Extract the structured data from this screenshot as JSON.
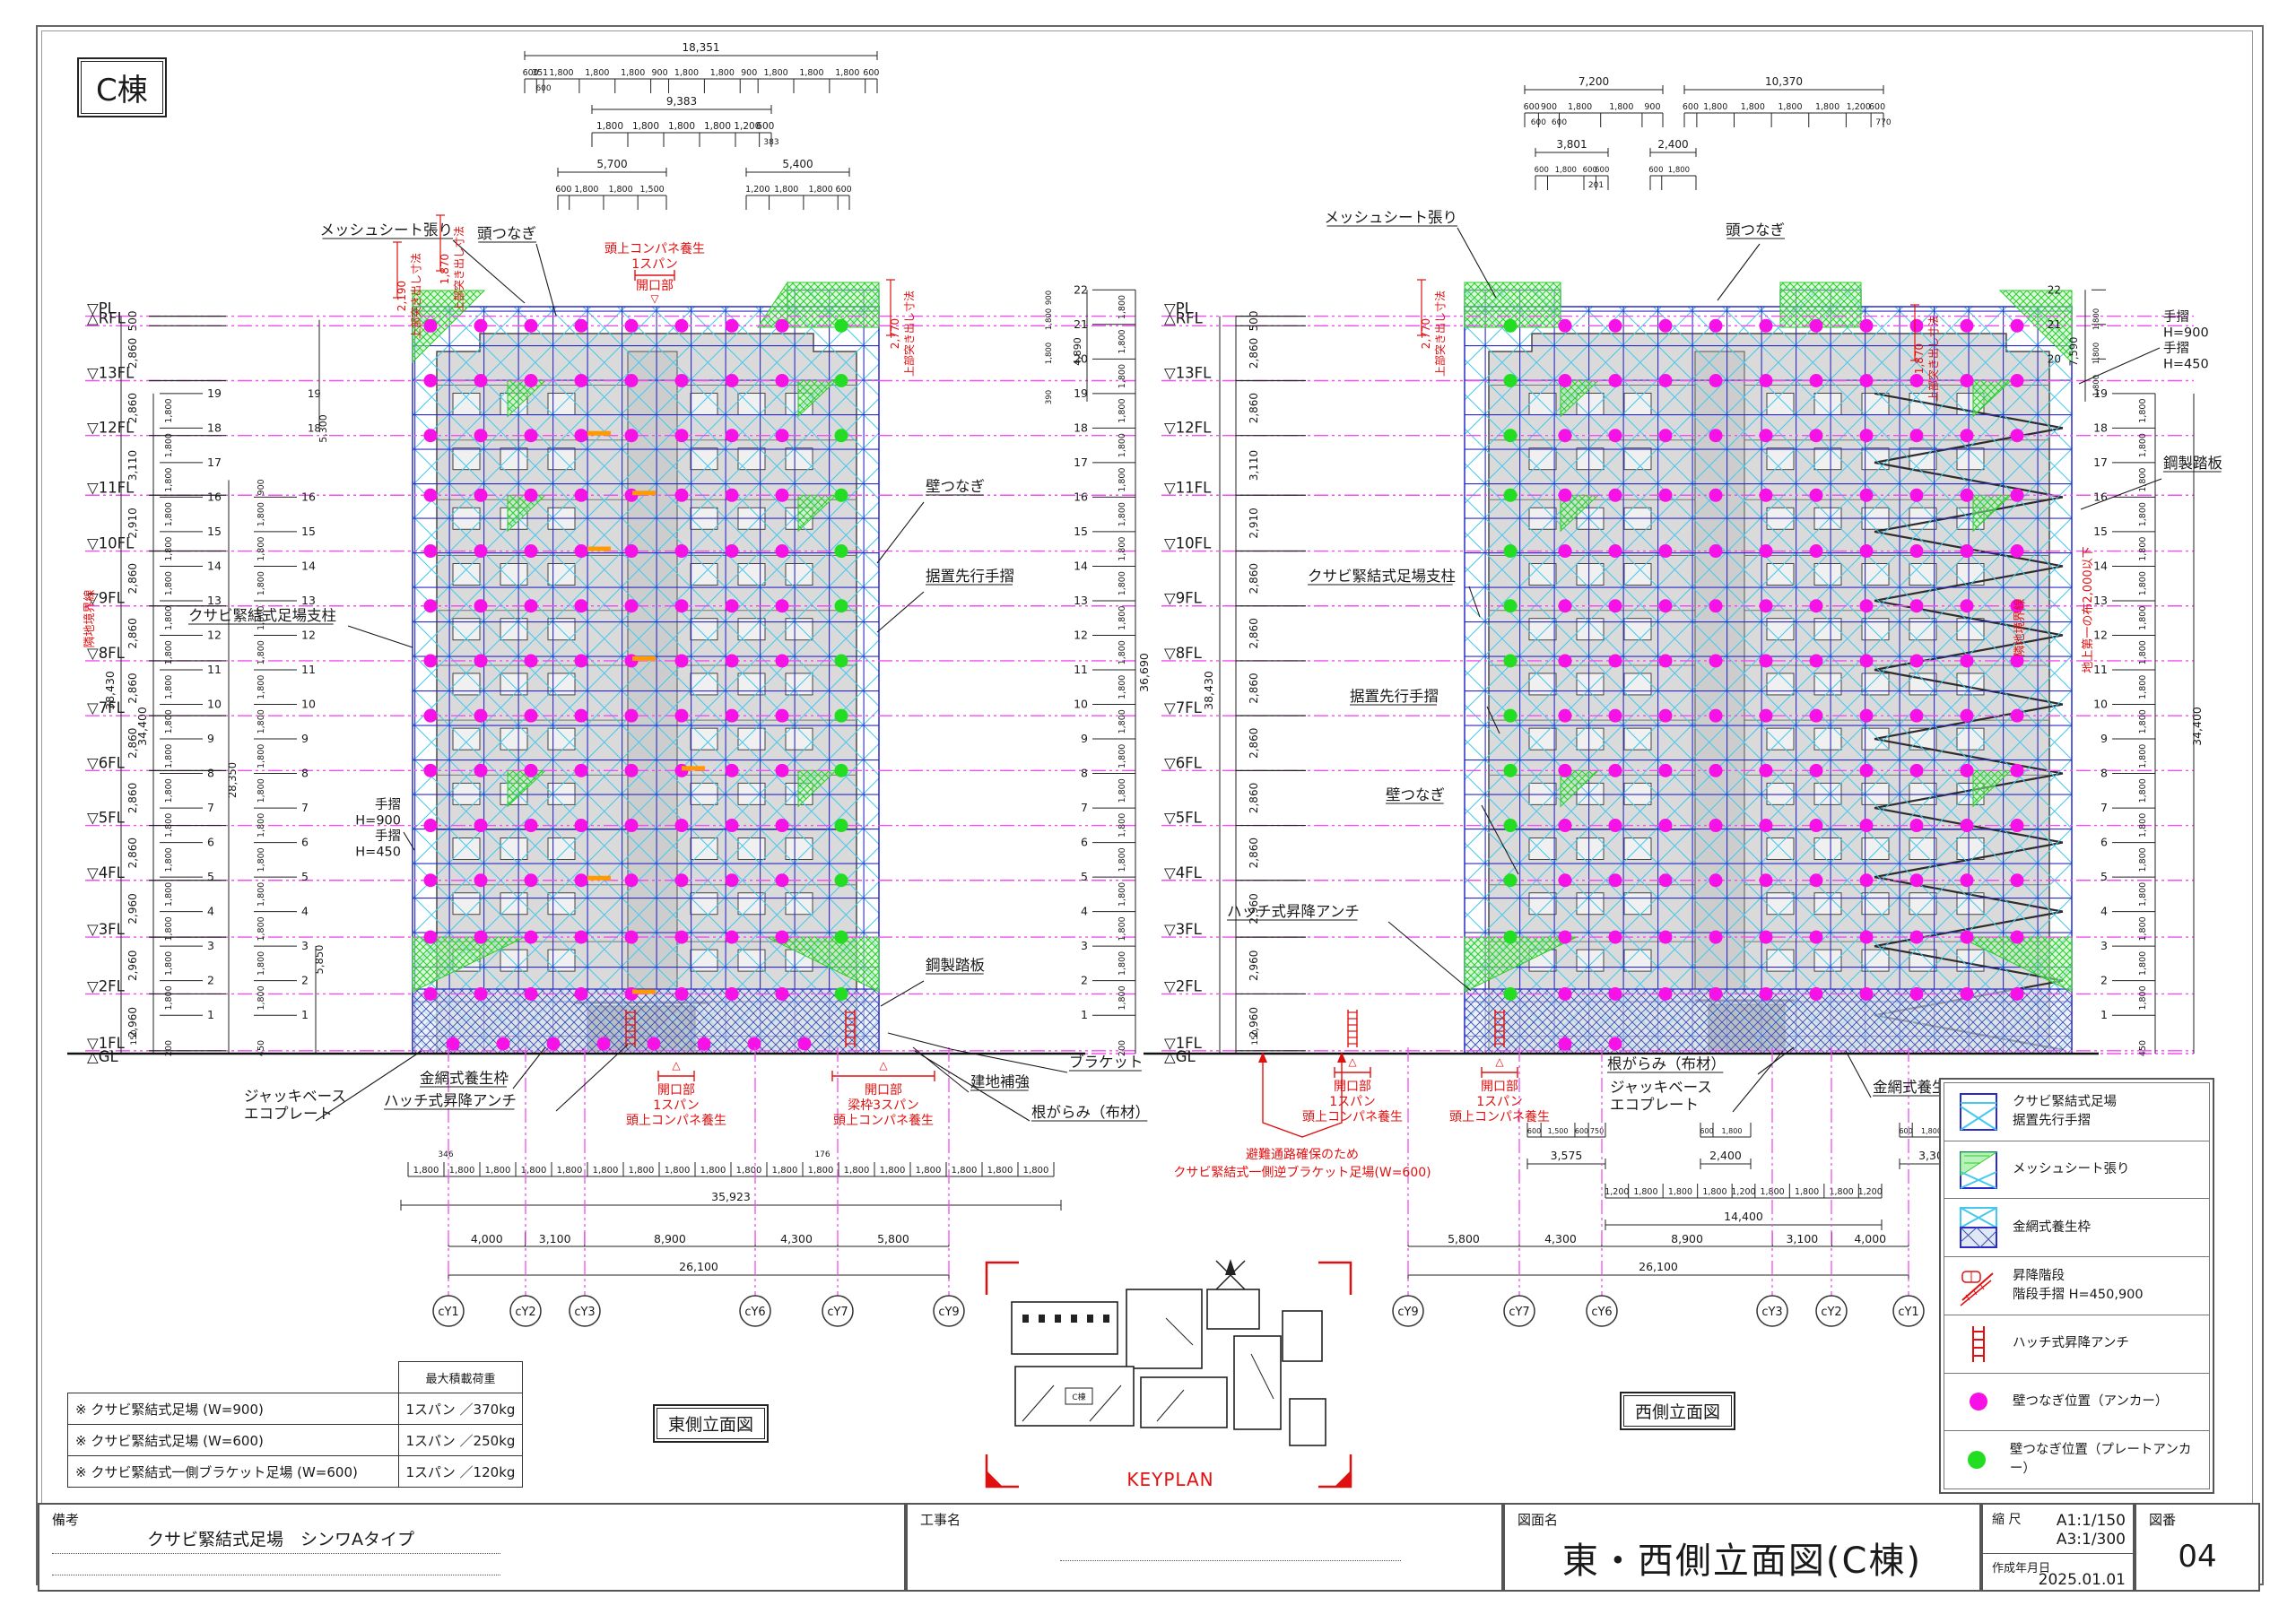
{
  "sheet": {
    "building": "C棟",
    "keyplan": "KEYPLAN",
    "east_view": "東側立面図",
    "west_view": "西側立面図"
  },
  "colors": {
    "anchor": "#f612e6",
    "plate_anchor": "#22dd22",
    "scaffold": "#2a2ac8",
    "brace": "#44c8f0",
    "mesh": "#2ecc2e",
    "red": "#e01010",
    "floor_line": "#f24df2",
    "building": "#dadada",
    "wire": "#3a50b0"
  },
  "floors": {
    "labels": [
      "▽PL",
      "△RFL",
      "▽13FL",
      "▽12FL",
      "▽11FL",
      "▽10FL",
      "▽9FL",
      "▽8FL",
      "▽7FL",
      "▽6FL",
      "▽5FL",
      "▽4FL",
      "▽3FL",
      "▽2FL",
      "▽1FL",
      "△GL"
    ],
    "gaps": [
      "500",
      "2,860",
      "2,860",
      "3,110",
      "2,910",
      "2,860",
      "2,860",
      "2,860",
      "2,860",
      "2,860",
      "2,860",
      "2,960",
      "2,960",
      "2,960",
      "150"
    ],
    "gaps_mm": [
      500,
      2860,
      2860,
      3110,
      2910,
      2860,
      2860,
      2860,
      2860,
      2860,
      2860,
      2960,
      2960,
      2960,
      150
    ]
  },
  "verticals": {
    "total": "38,430",
    "inner": "34,400",
    "left2": "28,350",
    "left3": "5,850",
    "mid": "36,690",
    "sub": "4,890",
    "sub2": "5,300",
    "right": "7,590"
  },
  "levels": {
    "pitch": "1,800",
    "east_max": 22,
    "west_max": 22,
    "bases": {
      "b150": "150",
      "b200": "200",
      "b450": "450",
      "b390": "390",
      "b900": "900"
    }
  },
  "dims": {
    "east_top": [
      {
        "total": "18,351",
        "segs": [
          "600",
          "351",
          "1,800",
          "1,800",
          "1,800",
          "900",
          "1,800",
          "1,800",
          "900",
          "1,800",
          "1,800",
          "1,800",
          "600"
        ],
        "subs": [
          "600"
        ],
        "subAt": [
          1
        ]
      },
      {
        "total": "9,383",
        "segs": [
          "1,800",
          "1,800",
          "1,800",
          "1,800",
          "1,200",
          "600"
        ],
        "subs": [
          "383"
        ],
        "subAt": [
          5
        ]
      },
      {
        "total": "5,700",
        "segs": [
          "600",
          "1,800",
          "1,800",
          "1,500"
        ]
      },
      {
        "total": "5,400",
        "segs": [
          "1,200",
          "1,800",
          "1,800",
          "600"
        ]
      }
    ],
    "west_top": [
      {
        "total": "7,200",
        "segs": [
          "600",
          "900",
          "1,800",
          "1,800",
          "900"
        ],
        "subs": [
          "600",
          "600"
        ],
        "subAt": [
          0,
          1
        ]
      },
      {
        "total": "10,370",
        "segs": [
          "600",
          "1,800",
          "1,800",
          "1,800",
          "1,800",
          "1,200",
          "600"
        ],
        "subs": [
          "770"
        ],
        "subAt": [
          6
        ]
      },
      {
        "total": "3,801",
        "segs": [
          "600",
          "1,800",
          "600",
          "600"
        ],
        "subs": [
          "201"
        ],
        "subAt": [
          2
        ]
      },
      {
        "total": "2,400",
        "segs": [
          "600",
          "1,800"
        ]
      }
    ],
    "east_bottom": {
      "span": "1,800",
      "count": 18,
      "micro": [
        "346",
        "176"
      ],
      "total": "35,923",
      "spans": [
        "4,000",
        "3,100",
        "8,900",
        "4,300",
        "5,800"
      ],
      "overall": "26,100"
    },
    "west_bottom": {
      "smalls": [
        {
          "total": "3,575",
          "segs": [
            "600",
            "1,500",
            "600",
            "750"
          ]
        },
        {
          "total": "2,400",
          "segs": [
            "600",
            "1,800"
          ]
        },
        {
          "total": "3,300",
          "segs": [
            "600",
            "1,800",
            "900"
          ]
        }
      ],
      "mid": {
        "total": "14,400",
        "segs": [
          "1,200",
          "1,800",
          "1,800",
          "1,800",
          "1,200",
          "1,800",
          "1,800",
          "1,800",
          "1,200"
        ]
      },
      "spans": [
        "5,800",
        "4,300",
        "8,900",
        "3,100",
        "4,000"
      ],
      "overall": "26,100"
    }
  },
  "grid": {
    "east": [
      "cY1",
      "cY2",
      "cY3",
      "cY6",
      "cY7",
      "cY9"
    ],
    "west": [
      "cY9",
      "cY7",
      "cY6",
      "cY3",
      "cY2",
      "cY1"
    ]
  },
  "notes": {
    "mesh_sheet": "メッシュシート張り",
    "head_tie": "頭つなぎ",
    "wall_tie": "壁つなぎ",
    "preset_rail": "据置先行手摺",
    "post": "クサビ緊結式足場支柱",
    "rail1": "手摺",
    "rail1v": "H=900",
    "rail2": "手摺",
    "rail2v": "H=450",
    "deck": "鋼製踏板",
    "bracket": "ブラケット",
    "wire_frame": "金網式養生枠",
    "hatch": "ハッチ式昇降アンチ",
    "jack1": "ジャッキベース",
    "jack2": "エコプレート",
    "reinforce": "建地補強",
    "sill": "根がらみ（布材）"
  },
  "red_notes": {
    "overhead": "頭上コンパネ養生",
    "span1": "1スパン",
    "opening": "開口部",
    "beam_span": "梁枠3スパン",
    "escape1": "避難通路確保のため",
    "escape2": "クサビ緊結式一側逆ブラケット足場(W=600)",
    "top_offset": "上部突き出し寸法",
    "v2190": "2,190",
    "v1870": "1,870",
    "v2770": "2,770",
    "boundary": "隣地境界線",
    "first_tie": "地上第一の布2,000以下"
  },
  "legend": {
    "items": [
      {
        "icon": "scaffold",
        "lines": [
          "クサビ緊結式足場",
          "据置先行手摺"
        ]
      },
      {
        "icon": "mesh",
        "lines": [
          "メッシュシート張り"
        ]
      },
      {
        "icon": "wire",
        "lines": [
          "金網式養生枠"
        ]
      },
      {
        "icon": "stair",
        "lines": [
          "昇降階段",
          "階段手摺 H=450,900"
        ]
      },
      {
        "icon": "ladder",
        "lines": [
          "ハッチ式昇降アンチ"
        ]
      },
      {
        "icon": "dot_anchor",
        "lines": [
          "壁つなぎ位置（アンカー）"
        ]
      },
      {
        "icon": "dot_plate",
        "lines": [
          "壁つなぎ位置（プレートアンカー）"
        ]
      }
    ]
  },
  "load_table": {
    "header": "最大積載荷重",
    "rows": [
      {
        "name": "※ クサビ緊結式足場 (W=900)",
        "value": "1スパン ／370kg"
      },
      {
        "name": "※ クサビ緊結式足場 (W=600)",
        "value": "1スパン ／250kg"
      },
      {
        "name": "※ クサビ緊結式一側ブラケット足場 (W=600)",
        "value": "1スパン ／120kg"
      }
    ]
  },
  "title_block": {
    "remarks_label": "備考",
    "remarks": "クサビ緊結式足場　シンワAタイプ",
    "project_label": "工事名",
    "drawing_label": "図面名",
    "drawing_name": "東・西側立面図(C棟)",
    "scale_label": "縮 尺",
    "scale1": "A1:1/150",
    "scale2": "A3:1/300",
    "date_label": "作成年月日",
    "date": "2025.01.01",
    "no_label": "図番",
    "no": "04"
  }
}
